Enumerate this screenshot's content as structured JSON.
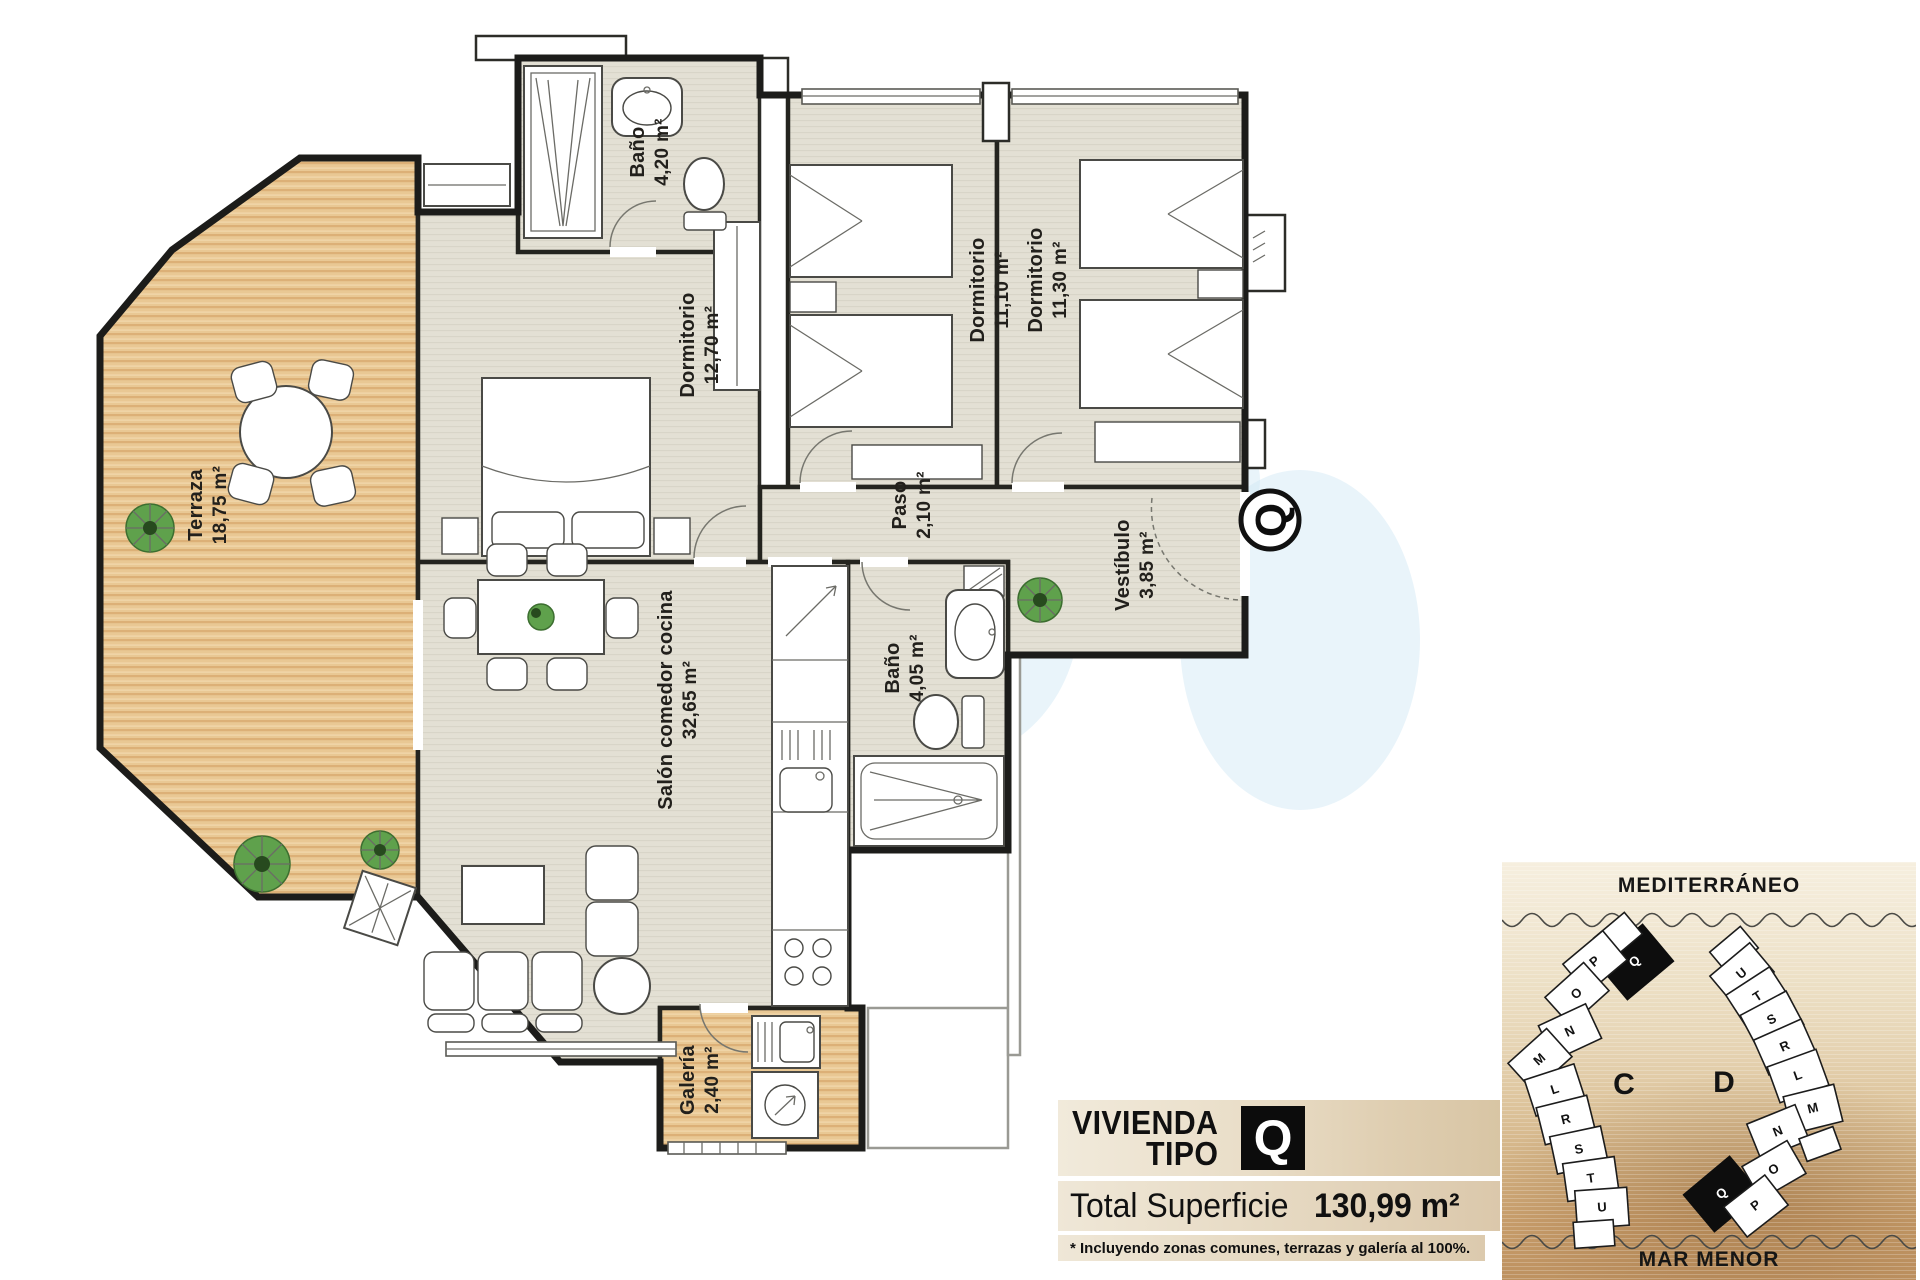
{
  "plan": {
    "rooms": [
      {
        "id": "terraza",
        "name": "Terraza",
        "area": "18,75 m²"
      },
      {
        "id": "bano1",
        "name": "Baño",
        "area": "4,20 m²"
      },
      {
        "id": "dorm1",
        "name": "Dormitorio",
        "area": "12,70 m²"
      },
      {
        "id": "dorm2",
        "name": "Dormitorio",
        "area": "11,10 m²"
      },
      {
        "id": "dorm3",
        "name": "Dormitorio",
        "area": "11,30 m²"
      },
      {
        "id": "paso",
        "name": "Paso",
        "area": "2,10 m²"
      },
      {
        "id": "vestibulo",
        "name": "Vestíbulo",
        "area": "3,85 m²"
      },
      {
        "id": "bano2",
        "name": "Baño",
        "area": "4,05 m²"
      },
      {
        "id": "salon",
        "name": "Salón comedor cocina",
        "area": "32,65 m²"
      },
      {
        "id": "galeria",
        "name": "Galería",
        "area": "2,40 m²"
      }
    ],
    "entrance_badge": "Q"
  },
  "site_plan": {
    "sea_top": "MEDITERRÁNEO",
    "sea_bottom": "MAR MENOR",
    "building_left_label": "C",
    "building_right_label": "D",
    "building_left_units": [
      "P",
      "Q",
      "O",
      "N",
      "M",
      "L",
      "R",
      "S",
      "T",
      "U"
    ],
    "building_right_units": [
      "U",
      "T",
      "S",
      "R",
      "L",
      "M",
      "N",
      "O",
      "Q",
      "P"
    ],
    "highlight_unit": "Q"
  },
  "info": {
    "title_line1": "VIVIENDA",
    "title_line2": "TIPO",
    "type_letter": "Q",
    "total_label": "Total Superficie",
    "total_value": "130,99 m²",
    "footnote": "* Incluyendo zonas comunes, terrazas y galería al 100%."
  },
  "colors": {
    "wall": "#1f1f1f",
    "floor": "#e3e0d4",
    "wood": "#e7c693",
    "highlight_black": "#0d0d0d",
    "watermark_blue": "#cfe7f3",
    "sand_dark": "#bd9160"
  }
}
